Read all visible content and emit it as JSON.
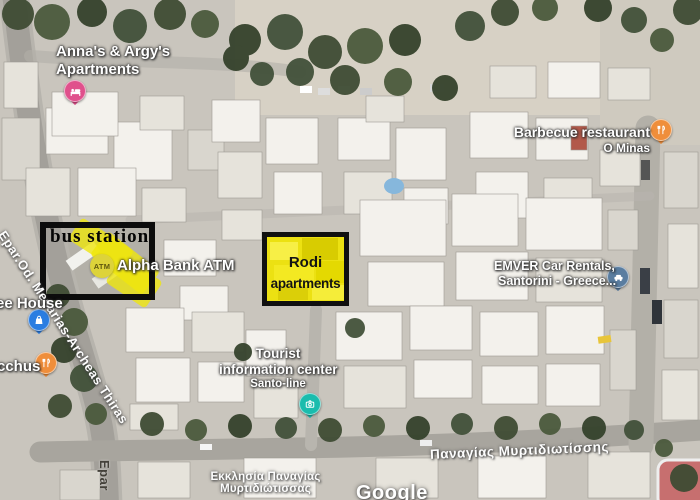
{
  "attribution": "Google",
  "pois": {
    "annas": {
      "line1": "Anna's & Argy's",
      "line2": "Apartments"
    },
    "barbecue": {
      "name": "Barbecue restaurant",
      "subtitle": "O Minas"
    },
    "coffee_house": {
      "name": "ee House"
    },
    "bacchus": {
      "name": "cchus"
    },
    "alpha_bank_atm": {
      "name": "Alpha Bank ATM",
      "badge": "ATM"
    },
    "emver": {
      "line1": "EMVER Car Rentals,",
      "line2": "Santorini - Greece..."
    },
    "tourist_info": {
      "line1": "Tourist",
      "line2": "information center",
      "line3": "Santo-line"
    }
  },
  "annotations": {
    "bus_station": {
      "label": "bus station"
    },
    "rodi": {
      "line1": "Rodi",
      "line2": "apartments"
    }
  },
  "streets": {
    "mesarias": "Epar.Od. Mesarias-Archeas Thiras",
    "epar_vertical": "Epar",
    "church_line1": "Εκκλησία Παναγίας",
    "church_line2": "Μυρτιδιώτισσας",
    "panagias": "Παναγίας Μυρτιδιωτίσσης"
  },
  "colors": {
    "lodging_pin": "#e0508c",
    "restaurant_pin": "#ef8e3b",
    "shopping_pin": "#2a7de1",
    "car_rental_pin": "#5a7da0",
    "attraction_pin": "#1abcad",
    "atm_badge_bg": "#ddd33a",
    "highlight_yellow": "#f0e70a",
    "annotation_border": "#0c0c0c"
  }
}
